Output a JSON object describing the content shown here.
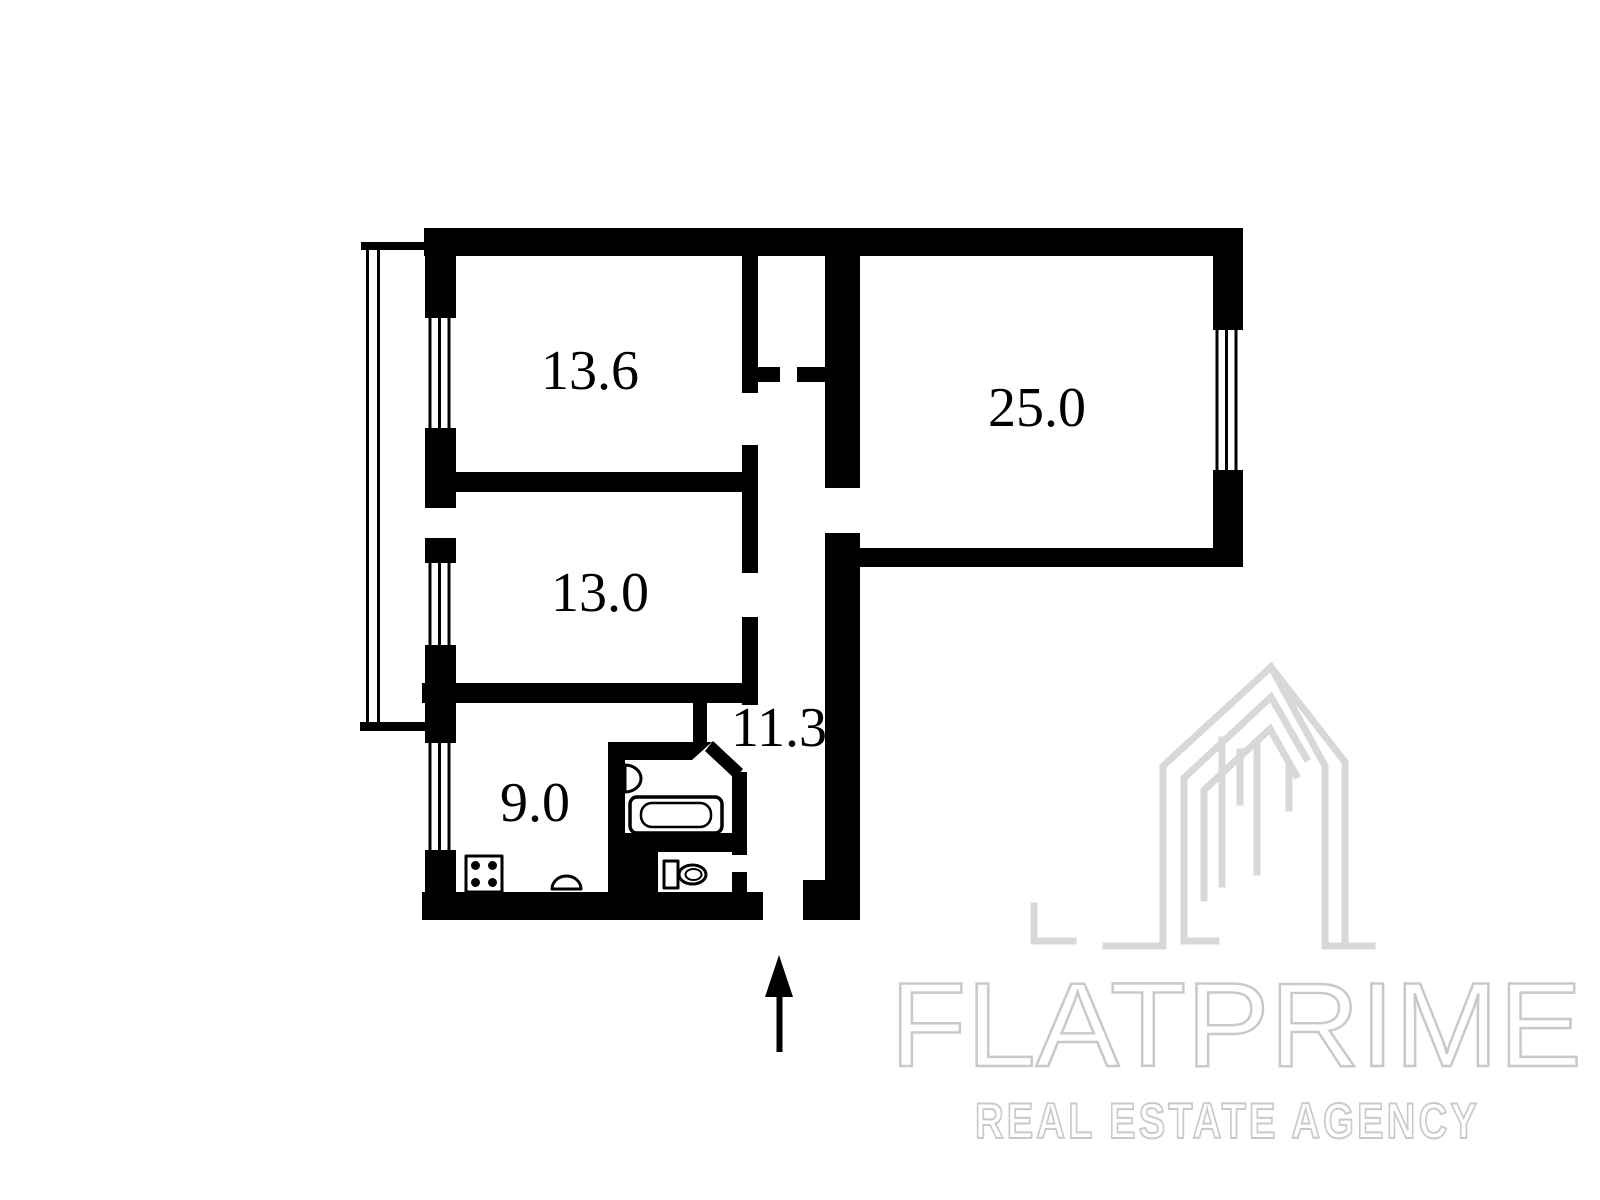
{
  "plan": {
    "type": "apartment-floor-plan",
    "rooms": {
      "bedroom_top": {
        "label": "13.6"
      },
      "living": {
        "label": "25.0"
      },
      "bedroom_mid": {
        "label": "13.0"
      },
      "hallway": {
        "label": "11.3"
      },
      "kitchen": {
        "label": "9.0"
      }
    },
    "fixtures": [
      "bathtub",
      "washbasin",
      "toilet",
      "stove",
      "kitchen-sink",
      "balcony",
      "entrance-arrow",
      "windows"
    ]
  },
  "watermark": {
    "brand": "FLATPRIME",
    "tagline": "REAL ESTATE AGENCY"
  },
  "colors": {
    "walls": "#000000",
    "background": "#ffffff",
    "watermark_text": "#c9c9c9",
    "watermark_logo": "#d8d8d8"
  }
}
